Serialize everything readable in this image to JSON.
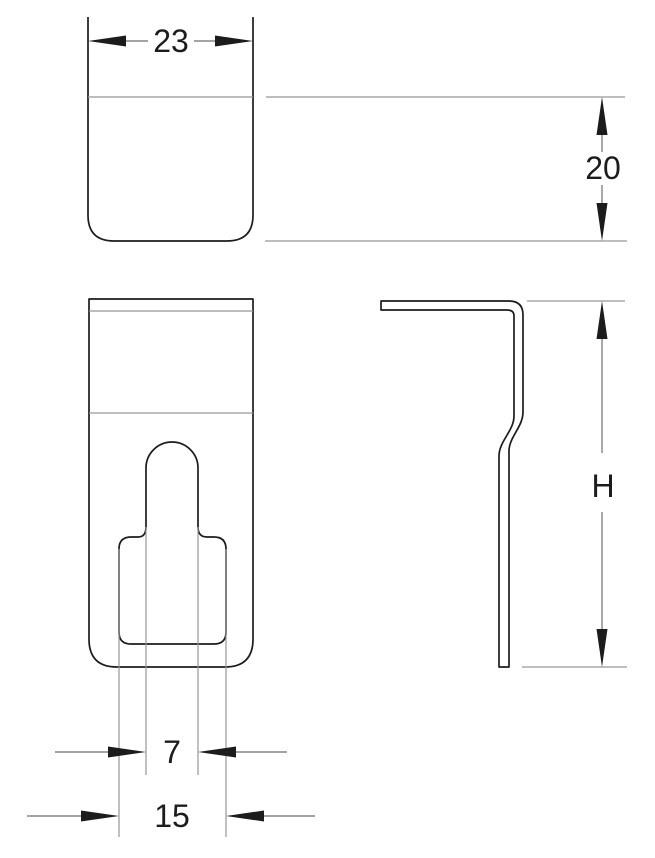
{
  "drawing": {
    "type": "technical-dimension-drawing",
    "subject": "sheet-metal clip / hook bracket, three orthographic views",
    "views": [
      "top-view",
      "front-view",
      "side-profile-view"
    ]
  },
  "dimensions": {
    "top_width": "23",
    "top_depth": "20",
    "slot_width": "7",
    "slot_opening": "15",
    "overall_height": "H"
  },
  "colors": {
    "background": "#ffffff",
    "part_outline": "#1c1c1c",
    "extension_lines": "#979797",
    "dimension_lines": "#6e6e6e",
    "arrowheads": "#1c1c1c",
    "dimension_text": "#1c1c1c"
  }
}
